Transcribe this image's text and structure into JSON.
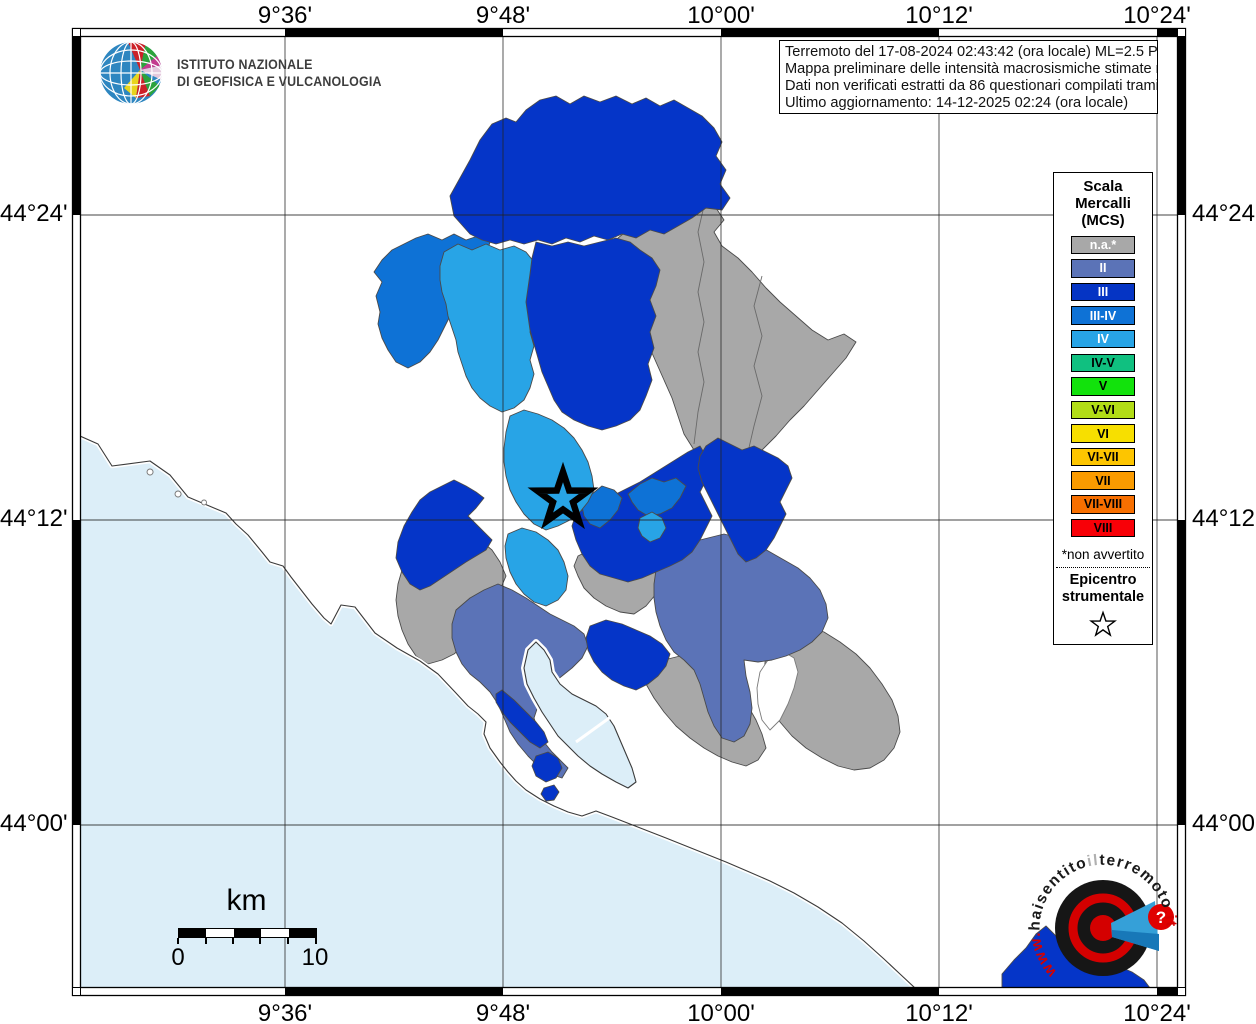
{
  "axis": {
    "top": [
      "9°36'",
      "9°48'",
      "10°00'",
      "10°12'",
      "10°24'"
    ],
    "bottom": [
      "9°36'",
      "9°48'",
      "10°00'",
      "10°12'",
      "10°24'"
    ],
    "left": [
      "44°24'",
      "44°12'",
      "44°00'"
    ],
    "right": [
      "44°24'",
      "44°12'",
      "44°00'"
    ]
  },
  "ingv_logo": {
    "line1": "ISTITUTO NAZIONALE",
    "line2": "DI GEOFISICA E VULCANOLOGIA"
  },
  "info_box": {
    "lines": [
      "Terremoto del 17-08-2024 02:43:42 (ora locale) ML=2.5 Prof=13 km",
      "Mappa preliminare delle intensità macrosismiche stimate nei comuni",
      "Dati non verificati estratti da 86 questionari compilati tramite Internet.",
      "Ultimo aggiornamento: 14-12-2025 02:24 (ora locale)"
    ]
  },
  "legend": {
    "title_lines": [
      "Scala",
      "Mercalli",
      "(MCS)"
    ],
    "items": [
      {
        "label": "n.a.*",
        "color": "#a8a8a8",
        "text_color": "#ffffff"
      },
      {
        "label": "II",
        "color": "#5b73b7",
        "text_color": "#ffffff"
      },
      {
        "label": "III",
        "color": "#0534c4",
        "text_color": "#ffffff"
      },
      {
        "label": "III-IV",
        "color": "#0e72d6",
        "text_color": "#ffffff"
      },
      {
        "label": "IV",
        "color": "#28a4e6",
        "text_color": "#ffffff"
      },
      {
        "label": "IV-V",
        "color": "#10c080",
        "text_color": "#000000"
      },
      {
        "label": "V",
        "color": "#12e20c",
        "text_color": "#000000"
      },
      {
        "label": "V-VI",
        "color": "#b2dd16",
        "text_color": "#000000"
      },
      {
        "label": "VI",
        "color": "#f7df00",
        "text_color": "#000000"
      },
      {
        "label": "VI-VII",
        "color": "#fdc500",
        "text_color": "#000000"
      },
      {
        "label": "VII",
        "color": "#fa9b00",
        "text_color": "#000000"
      },
      {
        "label": "VII-VIII",
        "color": "#f76f00",
        "text_color": "#000000"
      },
      {
        "label": "VIII",
        "color": "#f80007",
        "text_color": "#000000"
      }
    ],
    "footnote": "*non avvertito",
    "epicenter_title_lines": [
      "Epicentro",
      "strumentale"
    ]
  },
  "scale_bar": {
    "unit": "km",
    "min": "0",
    "max": "10"
  },
  "watermark": {
    "parts": [
      {
        "text": "www.",
        "color": "#d40000"
      },
      {
        "text": "haisentito",
        "color": "#1a1a1a"
      },
      {
        "text": "il",
        "color": "#b0b0b0"
      },
      {
        "text": "terremoto",
        "color": "#1a1a1a"
      },
      {
        "text": ".it",
        "color": "#d40000"
      }
    ],
    "question_mark": "?"
  },
  "map": {
    "class_colors": {
      "na": "#a8a8a8",
      "II": "#5b73b7",
      "III": "#0535c8",
      "III-IV": "#0e72d6",
      "IV": "#28a4e6",
      "sea": "#dceef8",
      "white": "#ffffff"
    },
    "grid": {
      "x": [
        285,
        503,
        721,
        939,
        1157
      ],
      "y": [
        215,
        520,
        825
      ],
      "x_range": [
        80,
        1178
      ],
      "y_range": [
        36,
        988
      ]
    },
    "epicenter": {
      "x": 563,
      "y": 499,
      "outer_r": 27,
      "inner_r": 10.5
    },
    "layers": [
      {
        "cls": "sea",
        "d": "M80,436 L98,444 L112,466 L150,461 L170,475 L188,497 L214,508 L226,513 L236,524 L248,535 L262,552 L270,562 L283,566 L291,577 L298,586 L312,604 L324,618 L331,624 L341,605 L355,607 L375,633 L397,648 L420,661 L438,674 L455,692 L468,706 L478,714 L486,722 L484,734 L490,748 L500,762 L508,772 L516,781 L526,790 L540,799 L554,806 L568,812 L582,816 L596,811 L612,817 L630,824 L648,831 L666,838 L686,846 L706,854 L726,862 L747,871 L770,881 L794,893 L818,907 L842,923 L864,941 L884,959 L900,974 L915,988 L80,988 Z"
      },
      {
        "cls": "na",
        "d": "M618,238 L638,222 L652,214 L668,206 L684,210 L700,202 L716,208 L724,220 L714,232 L722,246 L738,258 L752,272 L766,288 L780,302 L796,316 L812,330 L828,340 L844,334 L856,342 L846,358 L832,374 L818,390 L804,406 L790,420 L776,436 L762,450 L748,460 L734,466 L720,468 L706,462 L694,450 L684,434 L678,416 L672,398 L664,380 L656,362 L648,344 L640,326 L632,308 L626,290 L620,272 L616,254 Z"
      },
      {
        "cls": "iborder",
        "d": "M704,206 L698,232 L704,262 L698,292 L704,322 L698,352 L704,382 L698,412 L694,444"
      },
      {
        "cls": "iborder",
        "d": "M762,276 L754,306 L762,336 L754,366 L762,396 L754,426 L748,452"
      },
      {
        "cls": "na",
        "d": "M410,556 L424,544 L438,534 L452,526 L466,532 L480,540 L492,550 L500,562 L506,576 L500,590 L492,604 L484,618 L476,632 L466,644 L454,654 L442,660 L428,664 L416,656 L408,644 L402,630 L398,616 L396,600 L398,584 L402,570 Z"
      },
      {
        "cls": "na",
        "d": "M578,556 L594,548 L610,542 L626,546 L642,552 L656,558 L668,566 L664,580 L656,594 L646,606 L634,614 L620,612 L606,606 L594,598 L584,588 L578,576 L574,566 Z"
      },
      {
        "cls": "na",
        "d": "M648,668 L664,660 L680,656 L696,662 L712,670 L726,680 L738,692 L748,706 L756,720 L762,734 L766,748 L758,760 L746,766 L732,762 L718,756 L704,748 L690,738 L676,726 L664,712 L654,698 L646,684 Z"
      },
      {
        "cls": "na",
        "d": "M770,640 L788,630 L806,626 L824,632 L840,642 L856,654 L870,668 L882,684 L892,700 L898,716 L900,732 L894,748 L884,760 L870,768 L854,770 L838,766 L822,758 L806,748 L792,736 L780,722 L772,706 L766,690 L764,672 L766,654 Z"
      },
      {
        "cls": "white",
        "d": "M768,660 L784,652 L794,658 L798,672 L794,688 L788,704 L780,720 L770,730 L762,720 L758,704 L757,688 L760,672 Z"
      },
      {
        "cls": "II",
        "d": "M456,610 L470,598 L484,590 L498,584 L512,590 L526,598 L538,606 L550,614 L562,620 L574,626 L584,634 L588,646 L582,658 L572,668 L562,676 L552,684 L544,694 L538,706 L534,718 L538,730 L544,742 L552,752 L560,760 L568,768 L562,778 L550,774 L538,766 L528,756 L518,744 L510,732 L504,718 L498,704 L490,692 L480,682 L470,674 L462,664 L456,652 L452,638 L452,624 Z"
      },
      {
        "cls": "II",
        "d": "M660,556 L676,548 L692,542 L708,538 L724,534 L740,538 L756,544 L770,552 L784,560 L798,568 L810,578 L820,590 L826,604 L828,618 L822,632 L812,642 L800,650 L786,656 L772,660 L758,662 L744,660 L746,676 L750,692 L752,708 L750,724 L744,736 L734,742 L722,738 L714,726 L708,712 L704,698 L700,684 L694,670 L684,660 L674,652 L666,640 L660,626 L656,612 L654,598 L654,584 L656,570 Z"
      },
      {
        "cls": "III-IV",
        "d": "M380,312 L376,296 L382,282 L374,272 L382,260 L392,250 L404,244 L416,238 L428,234 L442,240 L454,234 L466,240 L478,236 L490,242 L486,256 L478,268 L470,280 L462,292 L456,304 L450,316 L444,328 L438,340 L430,352 L420,362 L408,368 L396,362 L388,350 L382,338 L378,324 Z"
      },
      {
        "cls": "IV",
        "d": "M444,252 L458,244 L472,250 L486,244 L500,250 L514,246 L526,252 L534,262 L530,276 L534,290 L530,304 L534,318 L530,332 L534,346 L530,360 L534,374 L530,388 L524,400 L514,408 L502,412 L490,406 L480,398 L472,388 L466,376 L462,364 L458,352 L456,340 L452,328 L448,316 L446,304 L442,292 L440,280 L440,266 Z"
      },
      {
        "cls": "III",
        "d": "M470,234 L454,216 L450,196 L460,178 L470,160 L480,140 L492,124 L506,118 L516,122 L526,110 L540,100 L556,96 L570,104 L584,96 L600,102 L616,96 L632,104 L646,98 L660,106 L674,100 L688,108 L702,116 L714,128 L722,142 L716,156 L726,170 L720,184 L730,198 L722,210 L706,208 L692,218 L678,226 L664,234 L650,230 L636,238 L622,234 L608,240 L594,236 L580,242 L566,238 L552,244 L538,240 L524,244 L510,240 L496,244 L482,240 Z"
      },
      {
        "cls": "III",
        "d": "M536,242 L552,246 L568,242 L584,246 L600,242 L616,238 L630,242 L640,250 L652,258 L660,270 L656,286 L650,300 L656,316 L650,332 L654,348 L648,364 L652,380 L646,396 L640,410 L630,420 L616,426 L602,430 L588,426 L574,420 L562,412 L554,400 L548,386 L542,372 L538,358 L534,344 L530,330 L528,316 L526,302 L528,288 L530,274 L532,258 Z"
      },
      {
        "cls": "III",
        "d": "M576,514 L592,504 L608,498 L624,490 L640,482 L656,472 L672,462 L688,452 L700,446 L706,456 L700,468 L706,480 L700,492 L706,504 L712,516 L706,528 L700,540 L692,552 L682,560 L670,566 L656,572 L642,578 L628,582 L614,578 L600,574 L590,566 L582,554 L576,540 L572,526 Z"
      },
      {
        "cls": "III",
        "d": "M706,446 L718,438 L730,444 L742,450 L754,446 L766,452 L778,458 L788,466 L792,478 L786,490 L780,502 L786,514 L780,526 L774,538 L766,550 L756,558 L746,562 L738,554 L732,542 L726,530 L720,518 L714,506 L708,494 L702,482 L698,468 L700,456 Z"
      },
      {
        "cls": "III",
        "d": "M398,542 L404,526 L412,512 L420,500 L430,492 L442,486 L454,480 L466,486 L476,492 L484,498 L476,508 L468,516 L476,524 L484,532 L492,540 L486,550 L476,556 L466,562 L454,570 L442,578 L430,586 L420,590 L410,584 L402,572 L396,558 Z"
      },
      {
        "cls": "III",
        "d": "M590,626 L606,620 L622,624 L636,630 L650,636 L662,644 L670,654 L666,666 L658,676 L648,684 L636,690 L624,686 L612,680 L602,672 L594,662 L588,650 L586,638 Z"
      },
      {
        "cls": "III",
        "d": "M1002,974 L1014,960 L1026,948 L1036,934 L1046,926 L1056,936 L1064,948 L1076,954 L1090,958 L1104,962 L1118,966 L1132,972 L1144,980 L1150,988 L1002,988 Z"
      },
      {
        "cls": "III-IV",
        "d": "M582,506 L592,494 L602,486 L614,490 L622,498 L618,510 L610,520 L600,528 L590,524 L584,516 Z"
      },
      {
        "cls": "III-IV",
        "d": "M628,494 L640,484 L652,478 L664,482 L676,478 L686,486 L680,498 L672,508 L660,514 L648,516 L638,510 L632,502 Z"
      },
      {
        "cls": "IV",
        "d": "M640,518 L652,512 L662,518 L666,528 L660,538 L650,542 L642,536 L638,528 Z"
      },
      {
        "cls": "IV",
        "d": "M510,416 L524,410 L538,414 L552,420 L564,428 L574,438 L582,450 L588,462 L592,476 L594,490 L588,502 L580,512 L570,520 L558,526 L546,530 L534,524 L524,514 L516,502 L510,490 L506,476 L504,462 L504,448 L506,432 Z"
      },
      {
        "cls": "IV",
        "d": "M508,534 L522,528 L536,532 L548,540 L558,550 L564,562 L568,576 L566,590 L558,600 L546,606 L534,602 L524,594 L516,584 L510,572 L506,558 L505,546 Z"
      },
      {
        "cls": "coast-halo",
        "d": "M80,436 L98,444 L112,466 L150,461 L170,475 L188,497 L214,508 L226,513 L236,524 L248,535 L262,552 L270,562 L283,566 L291,577 L298,586 L312,604 L324,618 L331,624 L341,605 L355,607 L375,633 L397,648 L420,661 L438,674 L455,692 L468,706 L478,714 L486,722 L484,734 L490,748 L500,762 L508,772 L516,781 L526,790 L540,799 L554,806 L568,812 L582,816 L596,811 L612,817 L630,824 L648,831 L666,838 L686,846 L706,854 L726,862 L747,871 L770,881 L794,893 L818,907 L842,923 L864,941 L884,959 L900,974 L915,988"
      },
      {
        "cls": "coast",
        "d": "M80,436 L98,444 L112,466 L150,461 L170,475 L188,497 L214,508 L226,513 L236,524 L248,535 L262,552 L270,562 L283,566 L291,577 L298,586 L312,604 L324,618 L331,624 L341,605 L355,607 L375,633 L397,648 L420,661 L438,674 L455,692 L468,706 L478,714 L486,722 L484,734 L490,748 L500,762 L508,772 L516,781 L526,790 L540,799 L554,806 L568,812 L582,816 L596,811 L612,817 L630,824 L648,831 L666,838 L686,846 L706,854 L726,862 L747,871 L770,881 L794,893 L818,907 L842,923 L864,941 L884,959 L900,974 L915,988"
      },
      {
        "cls": "gulf-halo",
        "d": "M528,650 L536,642 L544,650 L550,660 L552,672 L560,684 L572,694 L584,700 L596,706 L606,714 L614,726 L620,740 L626,754 L632,768 L636,782 L628,788 L616,782 L602,774 L590,766 L578,756 L568,746 L558,736 L550,724 L542,712 L534,698 L527,684 L524,668 Z"
      },
      {
        "cls": "gulf",
        "d": "M528,650 L536,642 L544,650 L550,660 L552,672 L560,684 L572,694 L584,700 L596,706 L606,714 L614,726 L620,740 L626,754 L632,768 L636,782 L628,788 L616,782 L602,774 L590,766 L578,756 L568,746 L558,736 L550,724 L542,712 L534,698 L527,684 L524,668 Z"
      },
      {
        "cls": "halo-line",
        "d": "M576,742 L612,716"
      },
      {
        "cls": "III",
        "d": "M502,690 L514,700 L526,712 L536,722 L544,732 L548,742 L540,748 L530,742 L520,732 L510,722 L502,712 L496,702 L496,694 Z"
      },
      {
        "cls": "III",
        "d": "M536,756 L548,752 L558,758 L562,768 L556,778 L546,782 L536,776 L532,766 Z"
      },
      {
        "cls": "III",
        "d": "M544,788 L554,785 L559,792 L554,800 L546,801 L541,794 Z"
      },
      {
        "cls": "white",
        "d": "M150,469 a3,3 0 1 0 0.1,0 Z"
      },
      {
        "cls": "white",
        "d": "M178,491 a3,3 0 1 0 0.1,0 Z"
      },
      {
        "cls": "white",
        "d": "M204,500 a2.5,2.5 0 1 0 0.1,0 Z"
      }
    ]
  }
}
